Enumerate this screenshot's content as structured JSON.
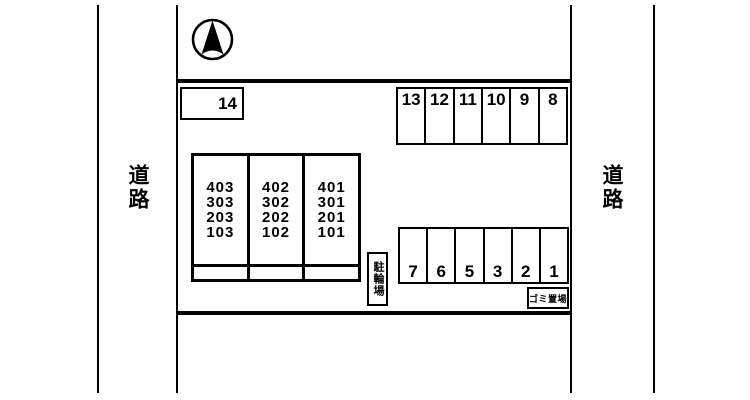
{
  "roads": {
    "left_label": "道路",
    "right_label": "道路"
  },
  "compass": {
    "icon": "north-arrow"
  },
  "parking": {
    "space_14": "14",
    "top_row": [
      "13",
      "12",
      "11",
      "10",
      "9",
      "8"
    ],
    "bottom_row": [
      "7",
      "6",
      "5",
      "3",
      "2",
      "1"
    ]
  },
  "building": {
    "columns": [
      {
        "rooms": [
          "403",
          "303",
          "203",
          "103"
        ]
      },
      {
        "rooms": [
          "402",
          "302",
          "202",
          "102"
        ]
      },
      {
        "rooms": [
          "401",
          "301",
          "201",
          "101"
        ]
      }
    ]
  },
  "facilities": {
    "bicycle_parking": "駐輪場",
    "garbage_area": "ゴミ置場"
  },
  "colors": {
    "line": "#000000",
    "background": "#ffffff"
  }
}
